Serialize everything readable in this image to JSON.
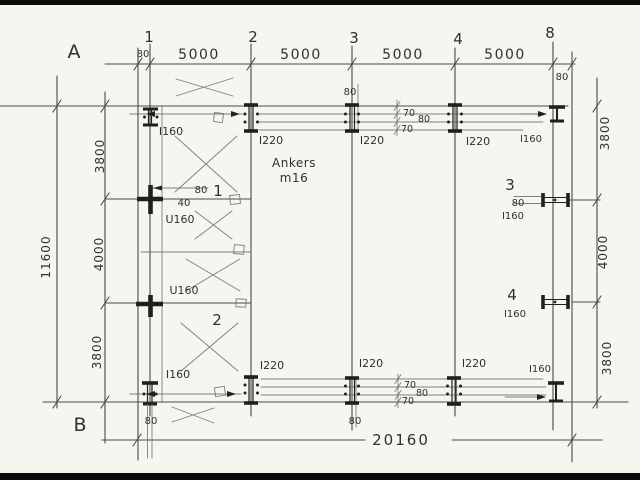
{
  "colors": {
    "paper": "#f6f5f0",
    "ink": "#4a4a48",
    "ink_dark": "#1f1f1e",
    "scan_edge": "#0b0b0b"
  },
  "grid": {
    "row_top_label": "A",
    "row_bottom_label": "B",
    "col_labels": [
      "1",
      "2",
      "3",
      "4",
      "8"
    ]
  },
  "dims": {
    "top": {
      "left_offset": "80",
      "bays": [
        "5000",
        "5000",
        "5000",
        "5000"
      ],
      "right_offset": "80"
    },
    "left": {
      "total": "11600",
      "segments": [
        "3800",
        "4000",
        "3800"
      ]
    },
    "right": {
      "segments": [
        "3800",
        "4000",
        "3800"
      ]
    },
    "bottom": {
      "total": "20160",
      "grid1_offset": "80",
      "grid3_offset": "80"
    },
    "beam_top": [
      "70",
      "80",
      "70"
    ],
    "beam_bottom": [
      "70",
      "80",
      "70"
    ],
    "grid3_top_offset": "80",
    "detail_80": "80",
    "detail_40": "40",
    "marker3_80": "80"
  },
  "profiles": {
    "top": {
      "g1": "I160",
      "g2": "I220",
      "g3": "I220",
      "g4": "I220",
      "right": "I160"
    },
    "bottom": {
      "g1": "I160",
      "g2": "I220",
      "g3": "I220",
      "g4": "I220",
      "right": "I160"
    },
    "girts": {
      "upper": "U160",
      "lower": "U160"
    },
    "right_side": {
      "m3": "I160",
      "m4": "I160"
    }
  },
  "markers": {
    "m1": "1",
    "m2": "2",
    "m3": "3",
    "m4": "4"
  },
  "note": {
    "line1": "Ankers",
    "line2": "m16"
  }
}
